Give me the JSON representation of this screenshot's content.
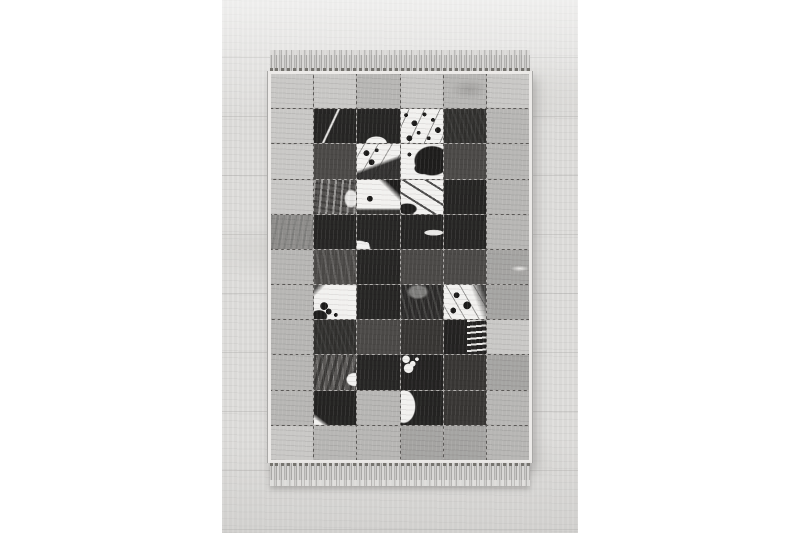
{
  "scene": {
    "type": "product-photo",
    "subject": "Black, white and grey patchwork cowhide-style rug with fringed ends lying on a light wooden floor",
    "canvas": {
      "width": 800,
      "height": 533,
      "background": "#ffffff"
    },
    "floor": {
      "color": "#dfdedc",
      "plank_line_color": "#969492"
    },
    "rug": {
      "rows": 11,
      "cols": 6,
      "fringe_color": "#c9c8c6",
      "binding_color": "#eceae8",
      "seam_color": "#5a5856",
      "palette": {
        "light_gray": "#c9c8c6",
        "mid_gray": "#b7b6b4",
        "gray": "#a5a4a2",
        "deep_gray": "#8f8e8c",
        "dark": "#4b4947",
        "darker": "#383634",
        "black": "#262524",
        "white": "#f2f1ef"
      },
      "cells": [
        [
          "g1",
          "g1",
          "g2",
          "g1",
          "g2b",
          "g1"
        ],
        [
          "g1",
          "d2s",
          "d2bb",
          "wsk",
          "d2t",
          "g2"
        ],
        [
          "g1",
          "d1",
          "wsd",
          "wbr",
          "d1",
          "g2"
        ],
        [
          "g1",
          "brd",
          "wbt",
          "ws3",
          "d2",
          "g2"
        ],
        [
          "g3b",
          "d2",
          "d2wj",
          "d2ws",
          "d2",
          "g2"
        ],
        [
          "g2",
          "d1b",
          "d2",
          "d1",
          "d1",
          "g3s"
        ],
        [
          "g2",
          "wsb",
          "d2",
          "dwt",
          "wsk2",
          "g3"
        ],
        [
          "g2",
          "d2t",
          "d1",
          "d1d",
          "bwf",
          "g1"
        ],
        [
          "g2",
          "gwb",
          "d2",
          "dws2",
          "d1d",
          "g3"
        ],
        [
          "g2",
          "d2wl",
          "g2",
          "wbl",
          "d1d",
          "g2"
        ],
        [
          "g1",
          "g2",
          "g2",
          "g3",
          "g3",
          "g2"
        ]
      ]
    }
  }
}
